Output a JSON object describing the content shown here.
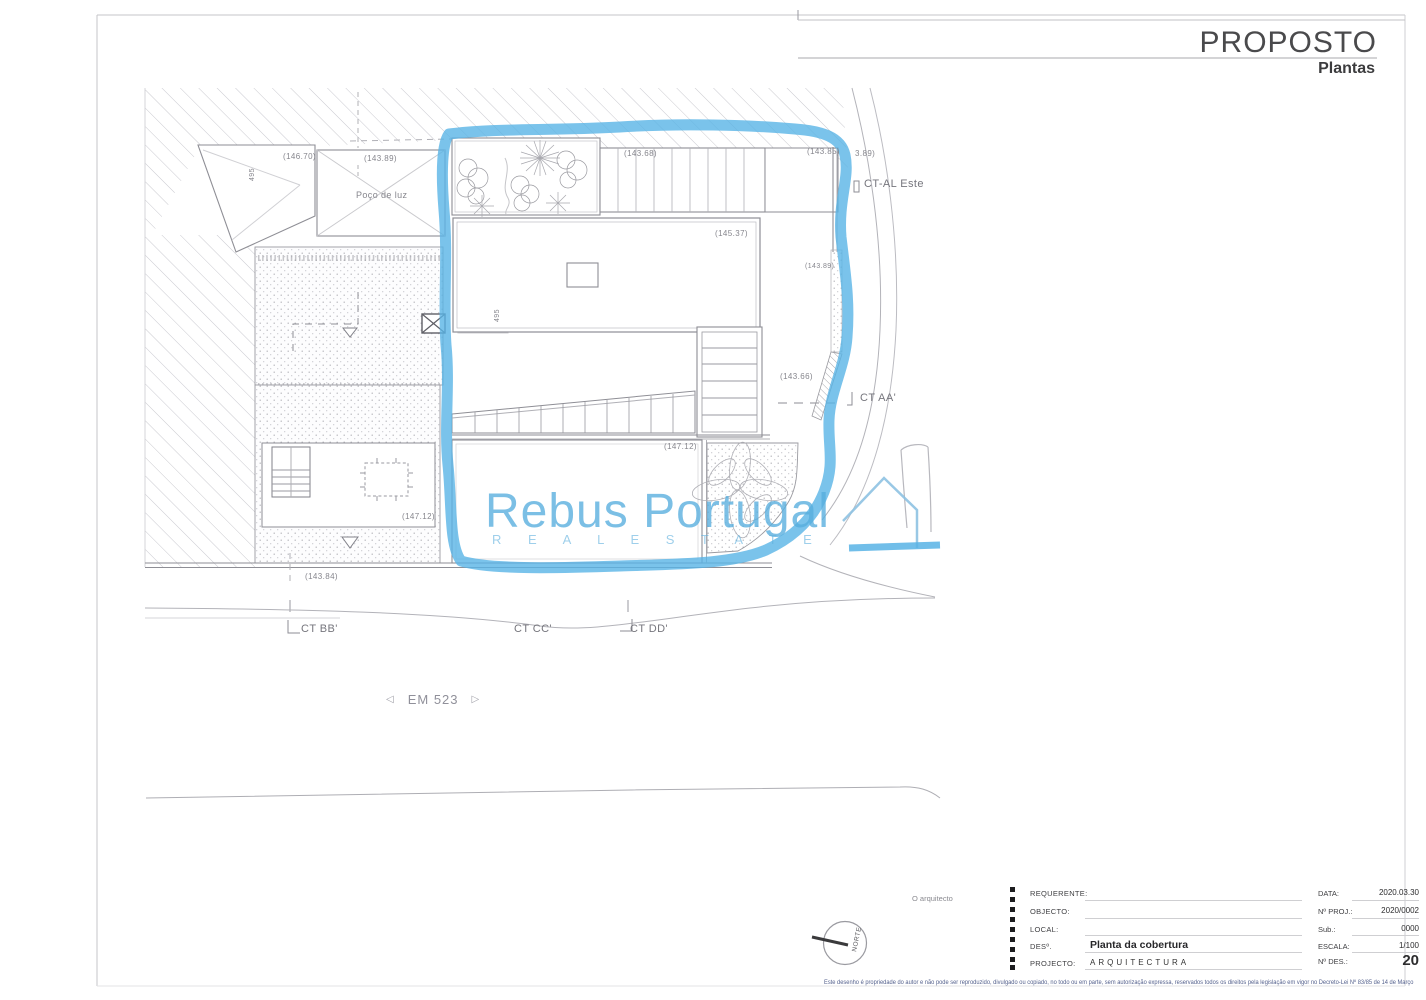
{
  "header": {
    "title": "PROPOSTO",
    "subtitle": "Plantas"
  },
  "watermark": {
    "name": "Rebus Portugal",
    "tagline": "R E A L   E S T A T E",
    "color": "#57aede"
  },
  "plan": {
    "marker_color": "#59b4e6",
    "labels": [
      {
        "text": "(146.70)",
        "x": 283,
        "y": 153,
        "fs": 8
      },
      {
        "text": "495",
        "x": 249,
        "y": 181,
        "fs": 7,
        "rot": -90
      },
      {
        "text": "(143.89)",
        "x": 364,
        "y": 155,
        "fs": 8
      },
      {
        "text": "Poço de luz",
        "x": 356,
        "y": 191,
        "fs": 9
      },
      {
        "text": "(143.68)",
        "x": 624,
        "y": 150,
        "fs": 8
      },
      {
        "text": "(143.85)",
        "x": 807,
        "y": 148,
        "fs": 8
      },
      {
        "text": "3.89)",
        "x": 855,
        "y": 150,
        "fs": 8
      },
      {
        "text": "CT-AL Este",
        "x": 864,
        "y": 179,
        "fs": 11,
        "ct": true
      },
      {
        "text": "(145.37)",
        "x": 715,
        "y": 230,
        "fs": 8
      },
      {
        "text": "(143.89)",
        "x": 805,
        "y": 263,
        "fs": 7
      },
      {
        "text": "495",
        "x": 494,
        "y": 322,
        "fs": 7,
        "rot": -90
      },
      {
        "text": "(143.66)",
        "x": 780,
        "y": 373,
        "fs": 8
      },
      {
        "text": "CT AA'",
        "x": 860,
        "y": 393,
        "fs": 11,
        "ct": true
      },
      {
        "text": "(147.12)",
        "x": 664,
        "y": 443,
        "fs": 8
      },
      {
        "text": "(147.12)",
        "x": 402,
        "y": 513,
        "fs": 8
      },
      {
        "text": "(143.84)",
        "x": 305,
        "y": 573,
        "fs": 8
      },
      {
        "text": "CT BB'",
        "x": 301,
        "y": 624,
        "fs": 11,
        "ct": true
      },
      {
        "text": "CT CC'",
        "x": 514,
        "y": 624,
        "fs": 11,
        "ct": true
      },
      {
        "text": "CT DD'",
        "x": 630,
        "y": 624,
        "fs": 11,
        "ct": true
      }
    ],
    "road": {
      "left_arrow": "◁",
      "label": "EM 523",
      "right_arrow": "▷"
    }
  },
  "north_label": "NORTE",
  "signature": "O arquitecto",
  "titleblock": {
    "fields": [
      {
        "label": "REQUERENTE:",
        "value": ""
      },
      {
        "label": "OBJECTO:",
        "value": ""
      },
      {
        "label": "LOCAL:",
        "value": ""
      },
      {
        "label": "DESº.",
        "value": "Planta da cobertura"
      },
      {
        "label": "PROJECTO:",
        "value": "ARQUITECTURA"
      }
    ],
    "meta": [
      {
        "label": "DATA:",
        "value": "2020.03.30"
      },
      {
        "label": "Nº PROJ.:",
        "value": "2020/0002"
      },
      {
        "label": "Sub.:",
        "value": "0000"
      },
      {
        "label": "ESCALA:",
        "value": "1/100"
      },
      {
        "label": "Nº DES.:",
        "value": "20"
      }
    ]
  },
  "disclaimer": "Este desenho é propriedade do autor e não pode ser reproduzido, divulgado ou copiado, no todo ou em parte, sem autorização expressa, reservados todos os direitos pela legislação em vigor no Decreto-Lei Nº 83/85 de 14 de Março"
}
